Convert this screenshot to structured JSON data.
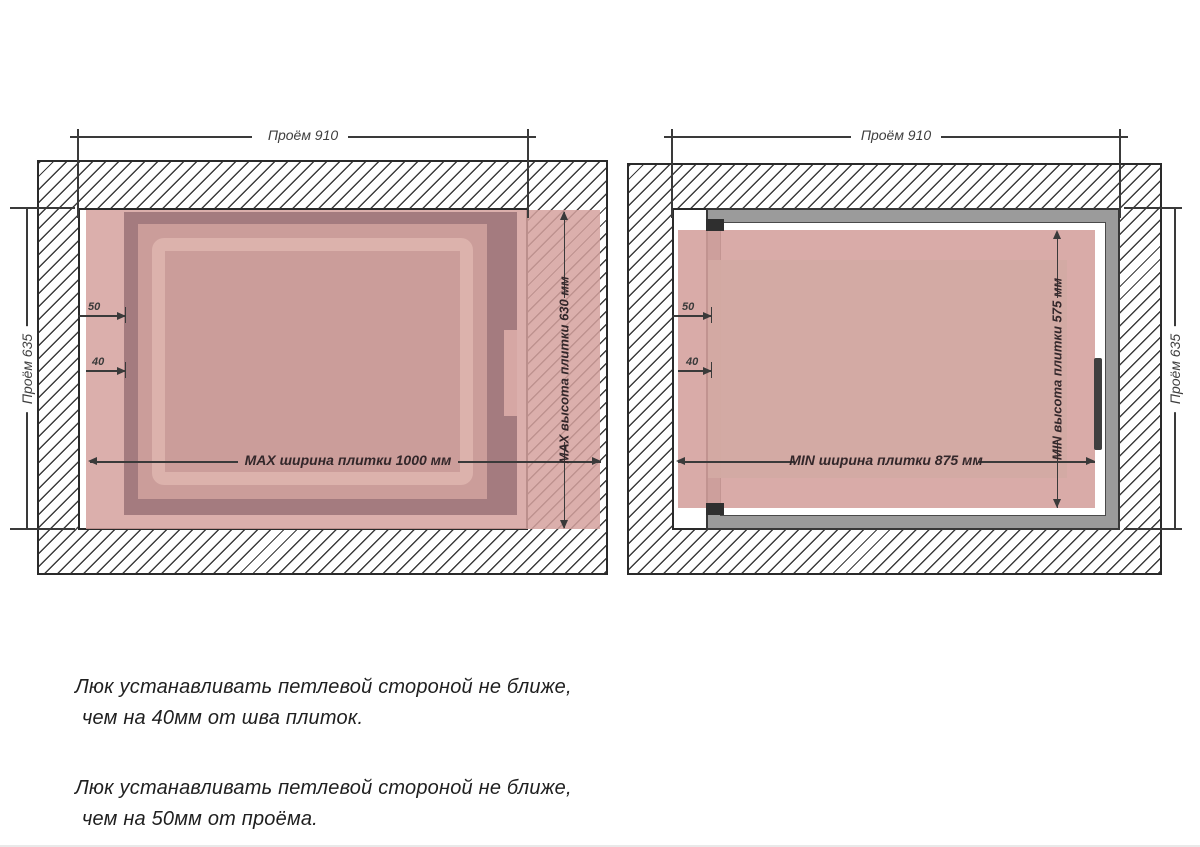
{
  "left_diagram": {
    "opening_width": "Проём 910",
    "opening_height": "Проём 635",
    "tile_width": "MAX ширина плитки 1000 мм",
    "tile_height": "MAX высота плитки 630 мм",
    "offset_from_opening": "50",
    "offset_from_seam": "40"
  },
  "right_diagram": {
    "opening_width": "Проём 910",
    "opening_height": "Проём 635",
    "tile_width": "MIN ширина плитки 875 мм",
    "tile_height": "MIN высота плитки 575 мм",
    "offset_from_opening": "50",
    "offset_from_seam": "40"
  },
  "notes": [
    {
      "line1": "Люк устанавливать петлевой стороной не ближе,",
      "line2": "чем на 40мм от шва плиток."
    },
    {
      "line1": "Люк устанавливать петлевой стороной не ближе,",
      "line2": "чем на 50мм от проёма."
    }
  ],
  "colors": {
    "tile": "#d5a19e",
    "frame_dark": "#a47b7f",
    "panel": "#cb9d9a",
    "lip": "#dcb2ac",
    "steel_frame": "#9b9b9b",
    "line": "#3a3a3a"
  }
}
